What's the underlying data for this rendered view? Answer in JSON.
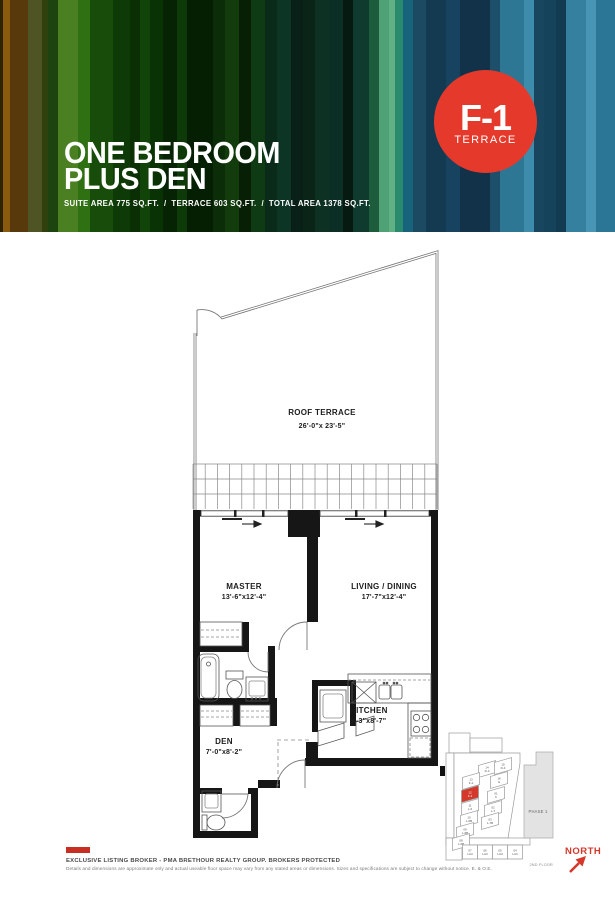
{
  "header": {
    "title_line1": "ONE BEDROOM",
    "title_line2": "PLUS DEN",
    "areas_line": "SUITE AREA 775 SQ.FT.  /  TERRACE 603 SQ.FT.  /  TOTAL AREA 1378 SQ.FT.",
    "badge": {
      "code": "F-1",
      "label": "TERRACE",
      "color": "#e53a2b"
    },
    "stripes": [
      {
        "w": 3,
        "c": "#2e2404"
      },
      {
        "w": 7,
        "c": "#8a5a0e"
      },
      {
        "w": 18,
        "c": "#58390b"
      },
      {
        "w": 14,
        "c": "#4e5424"
      },
      {
        "w": 6,
        "c": "#31410e"
      },
      {
        "w": 10,
        "c": "#1d430f"
      },
      {
        "w": 20,
        "c": "#4a8021"
      },
      {
        "w": 12,
        "c": "#2f7012"
      },
      {
        "w": 23,
        "c": "#174c0b"
      },
      {
        "w": 17,
        "c": "#0d3a06"
      },
      {
        "w": 10,
        "c": "#0a2f05"
      },
      {
        "w": 10,
        "c": "#124409"
      },
      {
        "w": 13,
        "c": "#0a3305"
      },
      {
        "w": 14,
        "c": "#062403"
      },
      {
        "w": 10,
        "c": "#0d3a08"
      },
      {
        "w": 26,
        "c": "#051f03"
      },
      {
        "w": 12,
        "c": "#0b2e08"
      },
      {
        "w": 14,
        "c": "#123c0c"
      },
      {
        "w": 12,
        "c": "#061f05"
      },
      {
        "w": 14,
        "c": "#0e3a14"
      },
      {
        "w": 12,
        "c": "#0a2a1a"
      },
      {
        "w": 14,
        "c": "#0c3526"
      },
      {
        "w": 12,
        "c": "#092018"
      },
      {
        "w": 12,
        "c": "#0a2417"
      },
      {
        "w": 14,
        "c": "#0d3122"
      },
      {
        "w": 14,
        "c": "#0b2f24"
      },
      {
        "w": 10,
        "c": "#061a12"
      },
      {
        "w": 16,
        "c": "#0e3b2e"
      },
      {
        "w": 10,
        "c": "#1d5c3c"
      },
      {
        "w": 10,
        "c": "#4ea275"
      },
      {
        "w": 6,
        "c": "#5fb183"
      },
      {
        "w": 8,
        "c": "#2a8a6e"
      },
      {
        "w": 10,
        "c": "#17637b"
      },
      {
        "w": 13,
        "c": "#1d4a63"
      },
      {
        "w": 20,
        "c": "#143a52"
      },
      {
        "w": 14,
        "c": "#174360"
      },
      {
        "w": 30,
        "c": "#113248"
      },
      {
        "w": 10,
        "c": "#1d4f6b"
      },
      {
        "w": 24,
        "c": "#2d7795"
      },
      {
        "w": 10,
        "c": "#3e8cab"
      },
      {
        "w": 10,
        "c": "#17465e"
      },
      {
        "w": 12,
        "c": "#16435c"
      },
      {
        "w": 10,
        "c": "#123a50"
      },
      {
        "w": 20,
        "c": "#35809f"
      },
      {
        "w": 10,
        "c": "#4895b5"
      },
      {
        "w": 19,
        "c": "#2b7697"
      }
    ]
  },
  "floorplan": {
    "rooms": [
      {
        "name": "ROOF TERRACE",
        "dims": "26'-0\"x 23'-5\""
      },
      {
        "name": "MASTER",
        "dims": "13'-6\"x12'-4\""
      },
      {
        "name": "LIVING / DINING",
        "dims": "17'-7\"x12'-4\""
      },
      {
        "name": "DEN",
        "dims": "7'-0\"x8'-2\""
      },
      {
        "name": "KITCHEN",
        "dims": "9'-3\"x8'-7\""
      }
    ]
  },
  "keyplan": {
    "highlight_color": "#d4382a",
    "highlighted_unit": "12 F-1",
    "phase_label": "PHASE 1",
    "floor_label": "2ND FLOOR",
    "units": [
      "14 D-3",
      "15 D-4",
      "13 F-2",
      "16 G",
      "12 F-1",
      "01 K",
      "11 L-6",
      "02 L-7",
      "10 L-6B",
      "03 L-7B",
      "09 L-6B",
      "08 L-6B",
      "07 LA3",
      "06 LA3",
      "05 LA3",
      "04 LA3"
    ]
  },
  "compass": {
    "label": "NORTH",
    "color": "#d5372b"
  },
  "footer": {
    "broker_line": "EXCLUSIVE LISTING BROKER - PMA BRETHOUR REALTY GROUP. BROKERS PROTECTED",
    "disclaimer": "Details and dimensions are approximate only and actual useable floor space may vary from any stated areas or dimensions. Sizes and specifications are subject to change without notice. E. & O.E."
  }
}
